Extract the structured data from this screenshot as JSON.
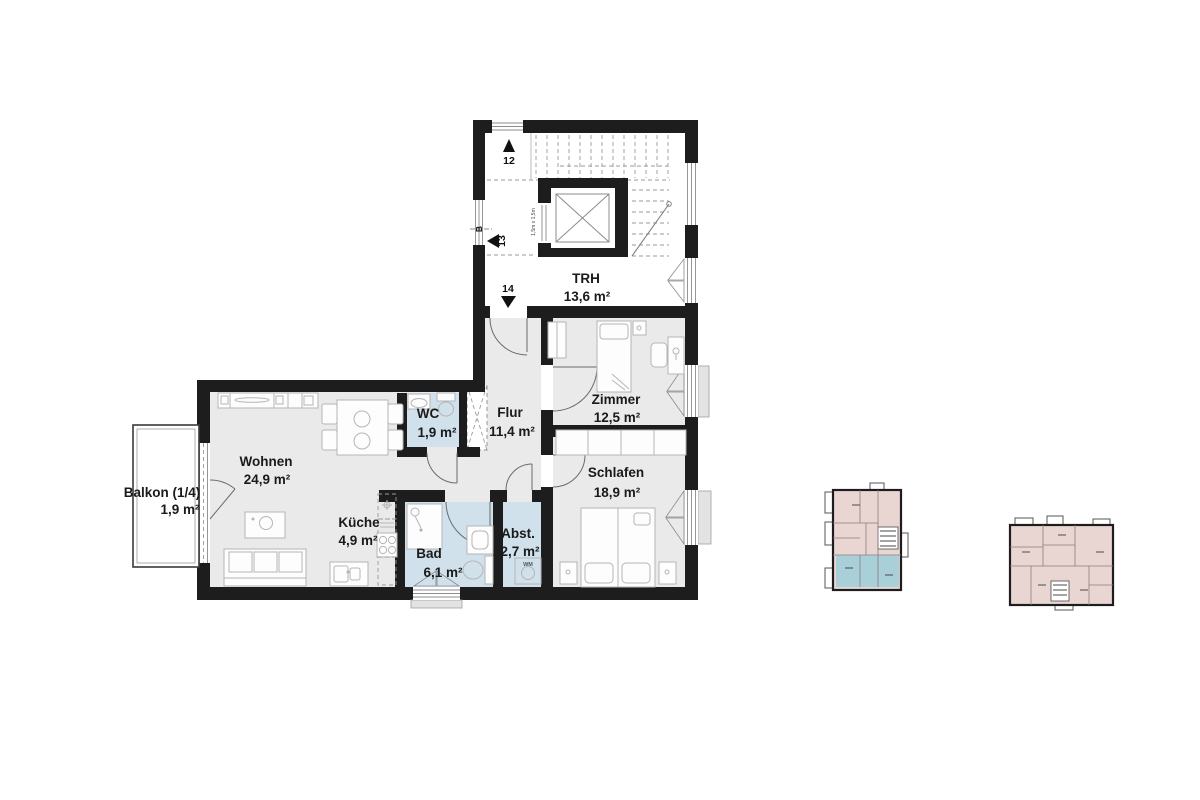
{
  "plan": {
    "rooms": {
      "trh": {
        "label": "TRH",
        "area": "13,6 m²"
      },
      "zimmer": {
        "label": "Zimmer",
        "area": "12,5 m²"
      },
      "schlafen": {
        "label": "Schlafen",
        "area": "18,9 m²"
      },
      "flur": {
        "label": "Flur",
        "area": "11,4 m²"
      },
      "wc": {
        "label": "WC",
        "area": "1,9 m²"
      },
      "wohnen": {
        "label": "Wohnen",
        "area": "24,9 m²"
      },
      "kueche": {
        "label": "Küche",
        "area": "4,9 m²"
      },
      "bad": {
        "label": "Bad",
        "area": "6,1 m²"
      },
      "abst": {
        "label": "Abst.",
        "area": "2,7 m²"
      },
      "balkon": {
        "label": "Balkon (1/4)",
        "area": "1,9 m²"
      }
    },
    "stairwell": {
      "step_numbers": [
        "12",
        "13",
        "14"
      ],
      "section_label": "B",
      "elevator_size_label": "1,5m x 1,5m"
    },
    "appliance_labels": {
      "washing_machine": "WM"
    }
  },
  "colors": {
    "wall": "#1d1d1d",
    "room_fill": "#eaeaea",
    "wet_room_fill": "#d0e1ec",
    "stairwell_fill": "#ffffff",
    "keyplan_pink": "#e9d6d3",
    "keyplan_blue": "#a9cfd9"
  }
}
